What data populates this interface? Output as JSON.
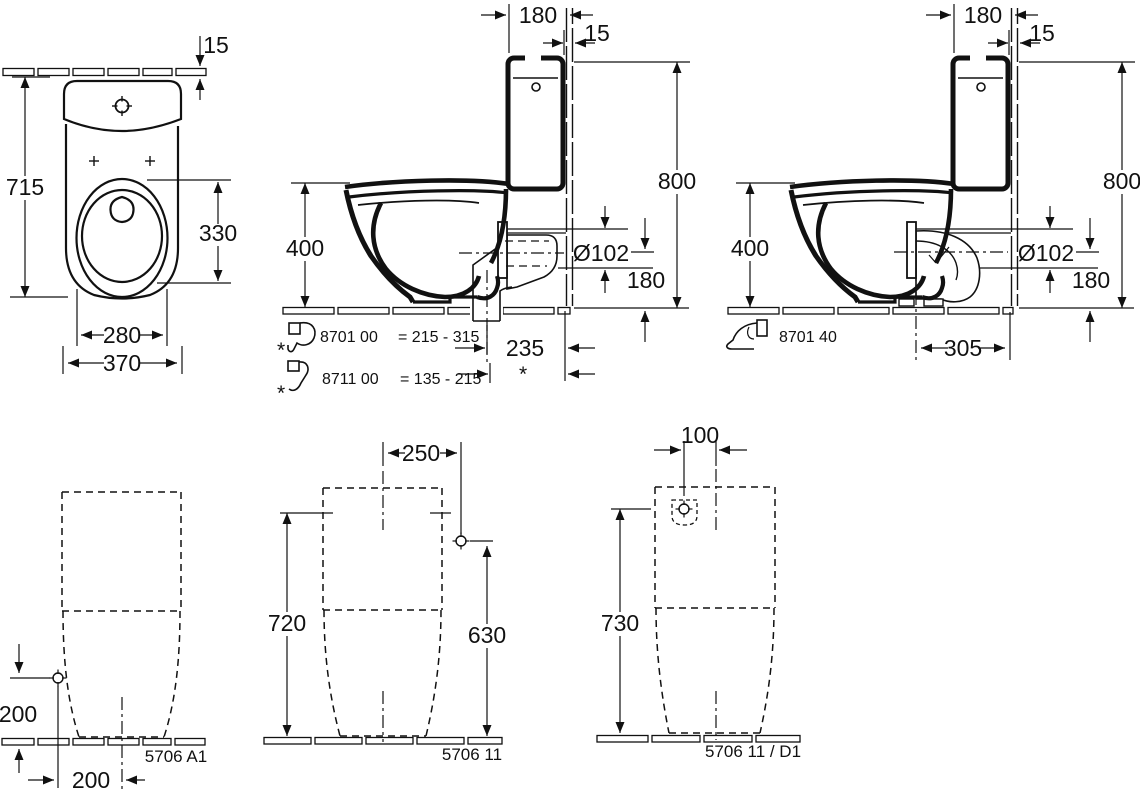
{
  "page": {
    "background": "#ffffff",
    "ink": "#111111"
  },
  "views": {
    "front": {
      "dim_wall_gap": "15",
      "dim_height": "715",
      "dim_seat_depth": "330",
      "dim_seat_width": "280",
      "dim_width": "370"
    },
    "vario": {
      "dim_cistern_depth": "180",
      "dim_wall": "15",
      "dim_total_height": "800",
      "dim_rim_height": "400",
      "dim_outlet_dia": "Ø102",
      "dim_outlet_height": "180",
      "dim_outlet_dist": "235",
      "dim_outlet_dist_var": "*",
      "note1_star": "*",
      "note1_code": "8701 00",
      "note1_range": "= 215 - 315",
      "note2_star": "*",
      "note2_code": "8711 00",
      "note2_range": "= 135 - 215"
    },
    "bend": {
      "dim_cistern_depth": "180",
      "dim_wall": "15",
      "dim_total_height": "800",
      "dim_rim_height": "400",
      "dim_outlet_dia": "Ø102",
      "dim_outlet_height": "180",
      "dim_outlet_dist": "305",
      "note_code": "8701 40"
    },
    "rear_a1": {
      "dim_inlet_height": "200",
      "dim_inlet_offset": "200",
      "code": "5706 A1"
    },
    "rear_11": {
      "dim_inlet_offset": "250",
      "dim_height": "720",
      "dim_inlet_height": "630",
      "code": "5706 11"
    },
    "rear_d1": {
      "dim_inlet_offset": "100",
      "dim_height": "730",
      "code": "5706 11 / D1"
    }
  }
}
